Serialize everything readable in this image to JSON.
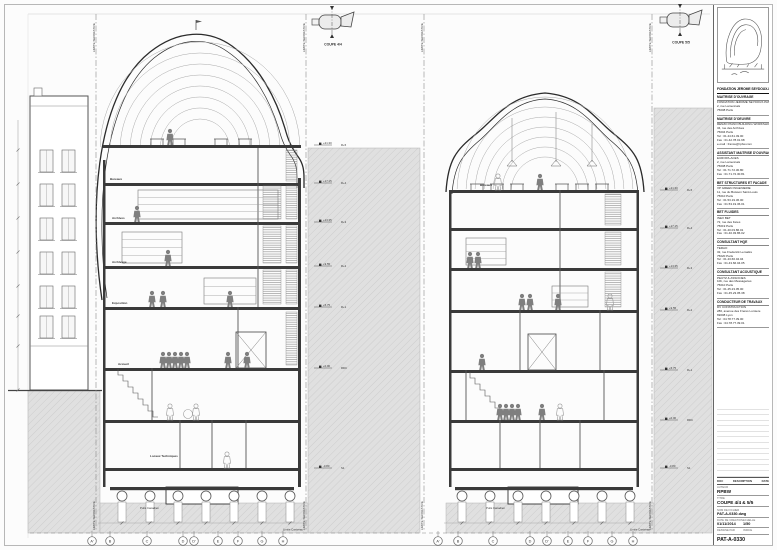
{
  "annotations": {
    "limite_separative": "LIMITE SEPARATIVE",
    "limite_caniveau": "Limite Caniveau",
    "puits_canadien": "Puits Canadien",
    "grid_letters": [
      "A'",
      "B",
      "C",
      "D",
      "D'",
      "E",
      "F",
      "G",
      "H"
    ],
    "levels": [
      {
        "tag": "R+5",
        "elev": "+21.30"
      },
      {
        "tag": "R+4",
        "elev": "+17.15"
      },
      {
        "tag": "R+3",
        "elev": "+13.35"
      },
      {
        "tag": "R+2",
        "elev": "+9.55"
      },
      {
        "tag": "R+1",
        "elev": "+5.75"
      },
      {
        "tag": "RDC",
        "elev": "+0.00"
      },
      {
        "tag": "S1",
        "elev": "-3.80"
      }
    ],
    "left_room_labels": [
      "Bureaux",
      "Archives",
      "Archivage",
      "Exposition",
      "Accueil",
      "Locaux Techniques"
    ],
    "right_room_labels": [
      "Bureaux"
    ],
    "key_left": "COUPE 4/4",
    "key_right": "COUPE 5/5"
  },
  "title_block": {
    "project": "FONDATION JEROME SEYDOUX-PATHE",
    "blocks": [
      {
        "header": "MAITRISE D'OUVRAGE",
        "lines": [
          "FONDATION JEROME SEYDOUX-PATHE",
          "2, rue Lamennais",
          "75008 Paris"
        ]
      },
      {
        "header": "MAITRISE D'OEUVRE",
        "lines": [
          "RENZO PIANO BUILDING WORKSHOP",
          "34, rue des Archives",
          "75004 Paris",
          "Tel : 01.44.61.49.00",
          "Fax : 01.42.78.01.98",
          "e-mail : france@rpbw.com"
        ]
      },
      {
        "header": "ASSISTANT MAITRISE D'OUVRAGE",
        "lines": [
          "EUROPA-ACES",
          "2, rue Lamennais",
          "75008 Paris",
          "Tel : 01.71.72.30.80",
          "Fax : 01.71.72.30.81"
        ]
      },
      {
        "header": "BET STRUCTURES ET FACADE",
        "lines": [
          "VP GREEN INGENIERIE",
          "11, rue du Buisson Saint-Louis",
          "75010 Paris",
          "Tel : 01.53.19.36.00",
          "Fax : 01.53.19.36.01"
        ]
      },
      {
        "header": "BET FLUIDES",
        "lines": [
          "INEX BET",
          "72, rue des Fetes",
          "75019 Paris",
          "Tel : 01.40.03.86.01",
          "Fax : 01.40.03.86.02"
        ]
      },
      {
        "header": "CONSULTANT HQE",
        "lines": [
          "TERAO",
          "32, rue Frederick Lemaitre",
          "75020 Paris",
          "Tel : 01.43.66.04.04",
          "Fax : 01.43.66.04.05"
        ]
      },
      {
        "header": "CONSULTANT ACOUSTIQUE",
        "lines": [
          "PEUTZ & ASSOCIES",
          "10b, rue des Messageries",
          "75010 Paris",
          "Tel : 01.45.23.05.00",
          "Fax : 01.45.23.05.38"
        ]
      },
      {
        "header": "CONDUCTEUR DE TRAVAUX",
        "lines": [
          "DV CONSTRUCTION",
          "280, avenue des Freres Lumiere",
          "69008 Lyon",
          "Tel : 04.78.77.39.00",
          "Fax : 04.78.77.39.01"
        ]
      }
    ],
    "rev_cols": [
      "DOC",
      "DESCRIPTION",
      "DATE"
    ],
    "fields": {
      "author_label": "AUTEUR",
      "author": "RPBW",
      "title_label": "TITRE",
      "drawing_title": "COUPE 4/4 & 5/5",
      "file_label": "NOM DE FICHIER",
      "file": "PAT-A-0330.dwg",
      "date_label": "DATE DE CREATION",
      "date": "01/11/2014",
      "scale_label": "ECHELLE",
      "scale": "1/50",
      "drawn_label": "DESSINE PAR",
      "index_label": "INDICE",
      "number": "PAT-A-0330"
    }
  }
}
